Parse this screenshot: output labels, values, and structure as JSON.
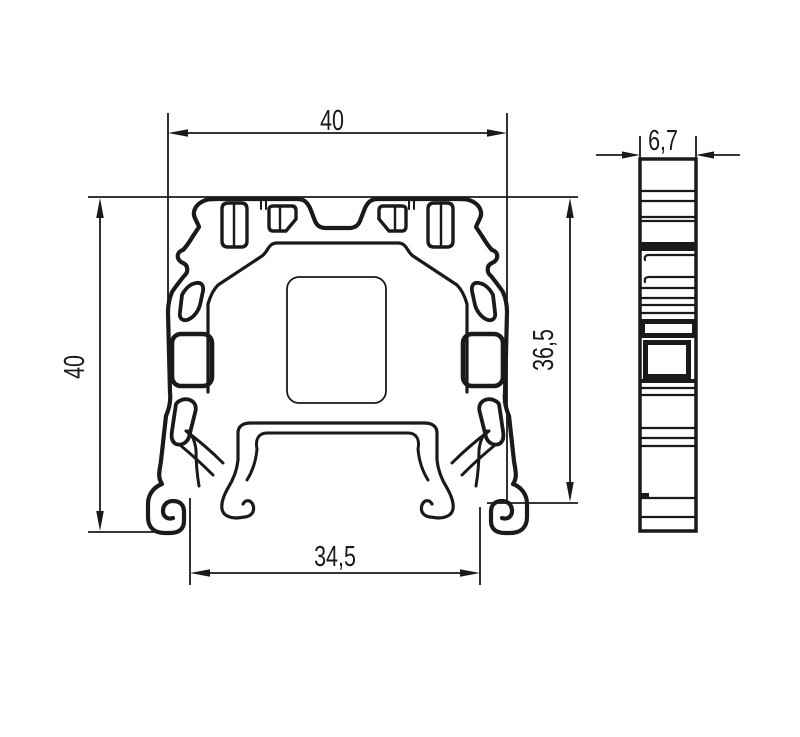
{
  "drawing": {
    "title": "terminal-block-cross-section-drawing",
    "views": [
      {
        "id": "front-view",
        "description": "front cross-section profile"
      },
      {
        "id": "side-view",
        "description": "narrow side profile"
      }
    ],
    "dimensions": {
      "front_width": "40",
      "front_height": "40",
      "right_height": "36,5",
      "bottom_width": "34,5",
      "side_width": "6,7"
    },
    "colors": {
      "line": "#1a1a1a",
      "background": "#ffffff"
    }
  }
}
